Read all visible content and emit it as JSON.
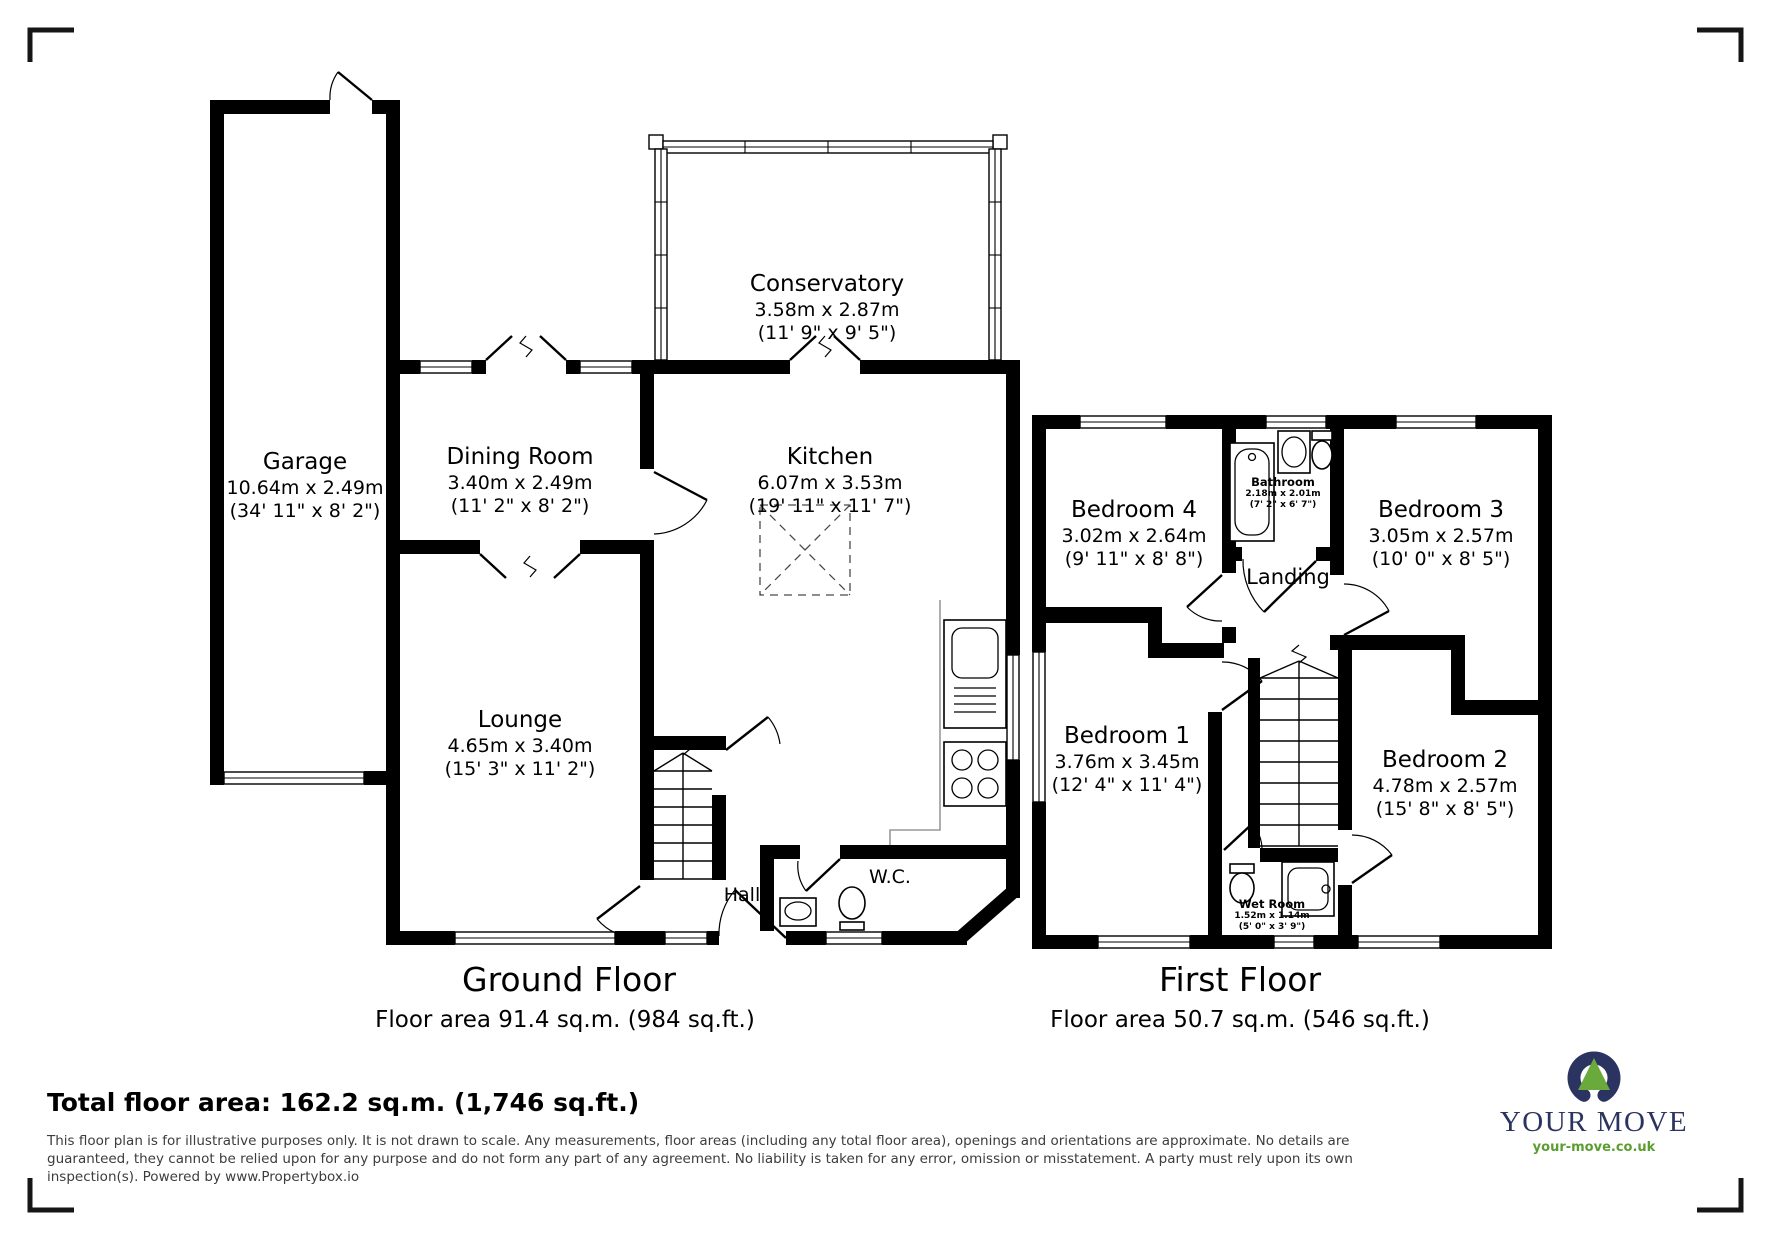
{
  "ground_floor": {
    "title": "Ground Floor",
    "area": "Floor area 91.4 sq.m. (984 sq.ft.)",
    "rooms": [
      {
        "id": "garage",
        "name": "Garage",
        "metric": "10.64m x 2.49m",
        "imperial": "(34' 11\" x 8' 2\")"
      },
      {
        "id": "dining-room",
        "name": "Dining Room",
        "metric": "3.40m x 2.49m",
        "imperial": "(11' 2\" x 8' 2\")"
      },
      {
        "id": "conservatory",
        "name": "Conservatory",
        "metric": "3.58m x 2.87m",
        "imperial": "(11' 9\" x 9' 5\")"
      },
      {
        "id": "kitchen",
        "name": "Kitchen",
        "metric": "6.07m x 3.53m",
        "imperial": "(19' 11\" x 11' 7\")"
      },
      {
        "id": "lounge",
        "name": "Lounge",
        "metric": "4.65m x 3.40m",
        "imperial": "(15' 3\" x 11' 2\")"
      },
      {
        "id": "hall",
        "name": "Hall"
      },
      {
        "id": "wc",
        "name": "W.C."
      }
    ]
  },
  "first_floor": {
    "title": "First Floor",
    "area": "Floor area 50.7 sq.m. (546 sq.ft.)",
    "rooms": [
      {
        "id": "bedroom4",
        "name": "Bedroom 4",
        "metric": "3.02m x 2.64m",
        "imperial": "(9' 11\" x 8' 8\")"
      },
      {
        "id": "bathroom",
        "name": "Bathroom",
        "metric": "2.18m x 2.01m",
        "imperial": "(7' 2\" x 6' 7\")"
      },
      {
        "id": "bedroom3",
        "name": "Bedroom 3",
        "metric": "3.05m x 2.57m",
        "imperial": "(10' 0\" x 8' 5\")"
      },
      {
        "id": "landing",
        "name": "Landing"
      },
      {
        "id": "bedroom1",
        "name": "Bedroom 1",
        "metric": "3.76m x 3.45m",
        "imperial": "(12' 4\" x 11' 4\")"
      },
      {
        "id": "bedroom2",
        "name": "Bedroom 2",
        "metric": "4.78m x 2.57m",
        "imperial": "(15' 8\" x 8' 5\")"
      },
      {
        "id": "wetroom",
        "name": "Wet Room",
        "metric": "1.52m x 1.14m",
        "imperial": "(5' 0\" x 3' 9\")"
      }
    ]
  },
  "summary": {
    "total": "Total floor area: 162.2 sq.m. (1,746 sq.ft.)"
  },
  "disclaimer": {
    "line1": "This floor plan is for illustrative purposes only. It is not drawn to scale. Any measurements, floor areas (including any total floor area), openings and orientations are approximate. No details are",
    "line2": "guaranteed, they cannot be relied upon for any purpose and do not form any part of any agreement. No liability is taken for any error, omission or misstatement. A party must rely upon its own",
    "line3": "inspection(s). Powered by www.Propertybox.io"
  },
  "logo": {
    "brand": "YOUR MOVE",
    "url": "your-move.co.uk",
    "navy": "#2b3360",
    "green": "#6aaa3c"
  }
}
